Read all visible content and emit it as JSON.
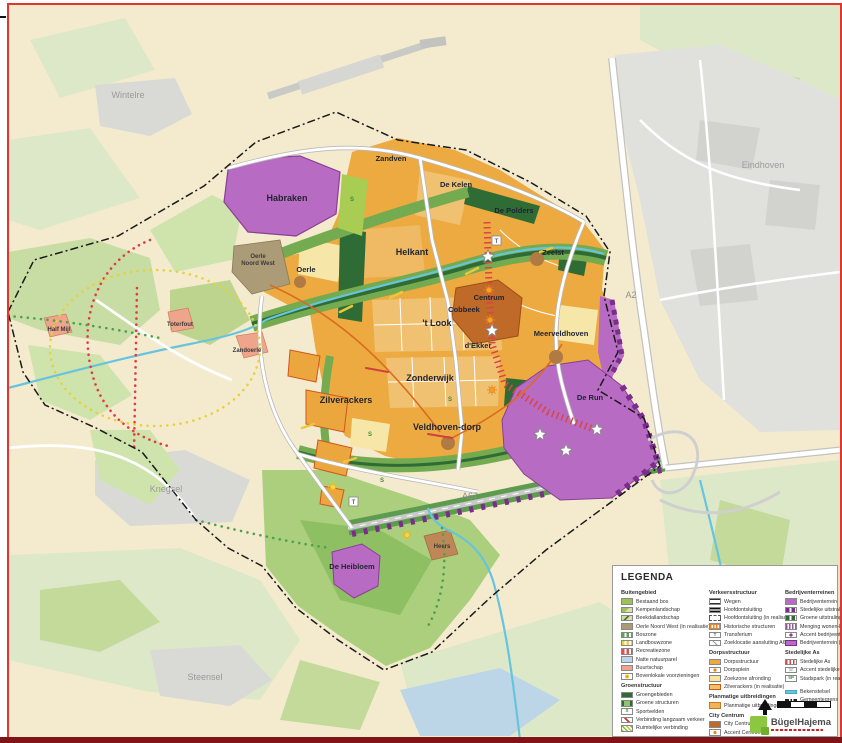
{
  "map": {
    "labels": {
      "wintelre": "Wintelre",
      "eindhoven": "Eindhoven",
      "knegsel": "Knegsel",
      "steensel": "Steensel",
      "habraken": "Habraken",
      "zandven": "Zandven",
      "de_kelen": "De Kelen",
      "de_polders": "De Polders",
      "oerle": "Oerle",
      "oerle_nw1": "Oerle",
      "oerle_nw2": "Noord West",
      "helkant": "Helkant",
      "zeelst": "Zeelst",
      "centrum": "Centrum",
      "cobbeek": "Cobbeek",
      "t_look": "'t Look",
      "d_ekker": "d'Ekker",
      "meerveldhoven": "Meerveldhoven",
      "zonderwijk": "Zonderwijk",
      "zandoerle": "Zandoerle",
      "zilverackers": "Zilverackers",
      "veldhoven_dorp": "Veldhoven-dorp",
      "de_run": "De Run",
      "de_heibloem": "De Heibloem",
      "half_mijl": "Half Mijl",
      "toterfout": "Toterfout",
      "heers": "Heers",
      "a2": "A2",
      "a67": "A67"
    },
    "colors": {
      "bedrijventerrein": "#b76bc2",
      "bedrijventerrein_rand": "#8a3f96",
      "dorpsstructuur": "#ecaa41",
      "city_centrum": "#bf6a28",
      "groengebieden": "#2f6b35",
      "groene_band": "#74ab50",
      "bekenstelsel": "#67c4dd",
      "stedelijke_as": "#d84545",
      "oerle_noord_west": "#ac9b77",
      "buurtschap": "#efa58c",
      "frame_red": "#e5342c",
      "frame_dark": "#7e1416"
    }
  },
  "legend": {
    "title": "LEGENDA",
    "glyphs": {
      "sport": "S",
      "transferium": "T",
      "stadspark": "SP",
      "star": "☆"
    },
    "col1": {
      "h1": "Buitengebied",
      "items1": [
        "Bestaand bos",
        "Kempenlandschap",
        "Beekdallandschap",
        "Oerle Noord West (in realisatie)",
        "Boszone",
        "Landbouwzone",
        "Recreatiezone",
        "Natte natuurparel",
        "Buurtschap",
        "Bovenlokale voorzieningen"
      ],
      "h2": "Groenstructuur",
      "items2": [
        "Groengebieden",
        "Groene structuren",
        "Sportvelden",
        "Verbinding langzaam verkeer",
        "Ruimtelijke verbinding"
      ]
    },
    "col2": {
      "h1": "Verkeersstructuur",
      "items1": [
        "Wegen",
        "Hoofdontsluiting",
        "Hoofdontsluiting (in realisatie)",
        "Historische structuren",
        "Transferium",
        "Zoeklocatie aansluiting A67"
      ],
      "h2": "Dorpsstructuur",
      "items2": [
        "Dorpsstructuur",
        "Dorpsplein",
        "Zoekzone afronding",
        "Zilverackers (in realisatie)"
      ],
      "h3": "Planmatige uitbreidingen",
      "items3": [
        "Planmatige uitbreidingen"
      ],
      "h4": "City Centrum",
      "items4": [
        "City Centrum",
        "Accent Centrum",
        "Verbinding accenten"
      ]
    },
    "col3": {
      "h1": "Bedrijventerreinen",
      "items1": [
        "Bedrijventerrein",
        "Stedelijke uitstraling",
        "Groene uitstraling",
        "Menging wonen-bedrijven",
        "Accent bedrijventerrein",
        "Bedrijventerrein (in realisatie)"
      ],
      "h2": "Stedelijke As",
      "items2": [
        "Stedelijke As",
        "Accent stedelijke as",
        "Stadspark (in realisatie)"
      ],
      "items3": [
        "Bekenstelsel",
        "Gemeentegrens"
      ]
    }
  },
  "logo": {
    "name": "BügelHajema"
  }
}
